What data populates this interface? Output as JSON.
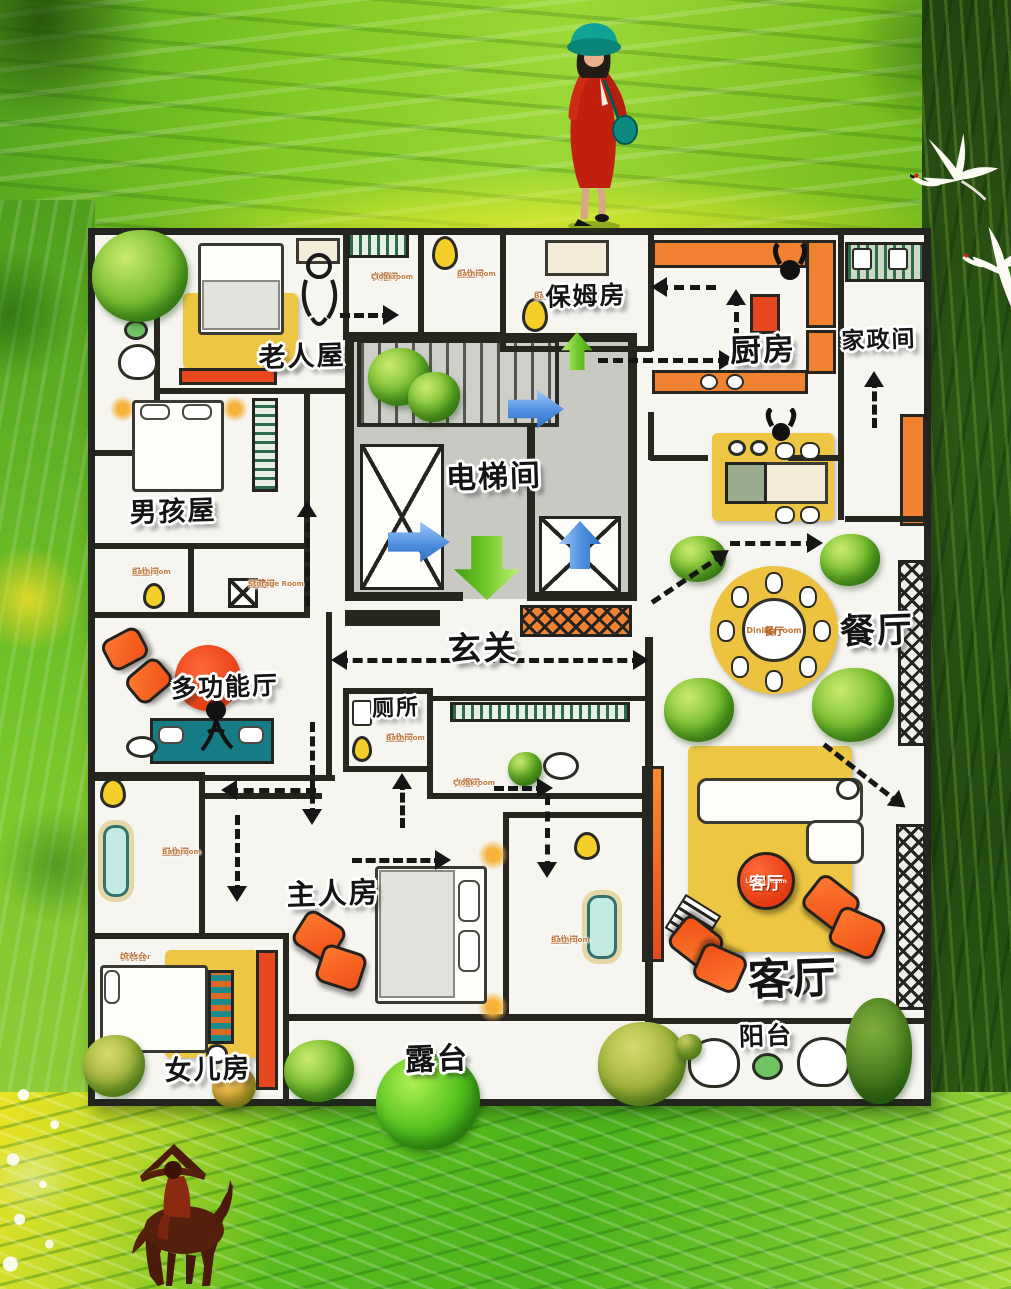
{
  "poster_title": "floor-plan-art-poster",
  "rooms": [
    {
      "id": "elder",
      "label": "老人屋"
    },
    {
      "id": "boy",
      "label": "男孩屋"
    },
    {
      "id": "nanny",
      "label": "保姆房"
    },
    {
      "id": "kitchen",
      "label": "厨房"
    },
    {
      "id": "housekeeping",
      "label": "家政间"
    },
    {
      "id": "elevator",
      "label": "电梯间"
    },
    {
      "id": "foyer",
      "label": "玄关"
    },
    {
      "id": "toilet",
      "label": "厕所"
    },
    {
      "id": "multi",
      "label": "多功能厅"
    },
    {
      "id": "dining",
      "label": "餐厅"
    },
    {
      "id": "master",
      "label": "主人房"
    },
    {
      "id": "daughter",
      "label": "女儿房"
    },
    {
      "id": "terrace",
      "label": "露台"
    },
    {
      "id": "living",
      "label": "客厅"
    },
    {
      "id": "balcony",
      "label": "阳台"
    }
  ],
  "small_labels": [
    {
      "zh": "衣帽间",
      "en": "Cloakroom"
    },
    {
      "zh": "卫生间",
      "en": "Bathroom"
    },
    {
      "zh": "卫生间",
      "en": "Bathroom"
    },
    {
      "zh": "卫生间",
      "en": "Bathroom"
    },
    {
      "zh": "储藏间",
      "en": "Storage Room"
    },
    {
      "zh": "卫生间",
      "en": "Bathroom"
    },
    {
      "zh": "衣帽间",
      "en": "Cloakroom"
    },
    {
      "zh": "卫生间",
      "en": "Bathroom"
    },
    {
      "zh": "卫生间",
      "en": "Bathroom"
    },
    {
      "zh": "梳妆台",
      "en": "Dresser"
    }
  ],
  "badges": {
    "dining": {
      "zh": "餐厅",
      "en": "Dining room"
    },
    "living": {
      "zh": "客厅",
      "en": "Living Room"
    }
  },
  "palette": {
    "grass_green": "#7cc62e",
    "forest_green": "#2d5716",
    "plan_white": "#f6f5f0",
    "wall_dark": "#26261f",
    "furniture_orange": "#ef4f16",
    "rug_yellow": "#edc744",
    "arrow_blue": "#4f8fe0",
    "arrow_green": "#6cc527",
    "toilet_yellow": "#f4cf2a",
    "sofa_teal": "#177b86",
    "badge_red": "#e33a10"
  },
  "decor": {
    "figures": [
      "woman-in-red",
      "horse-rider",
      "white-cranes"
    ],
    "plants": "round-brush-trees"
  }
}
